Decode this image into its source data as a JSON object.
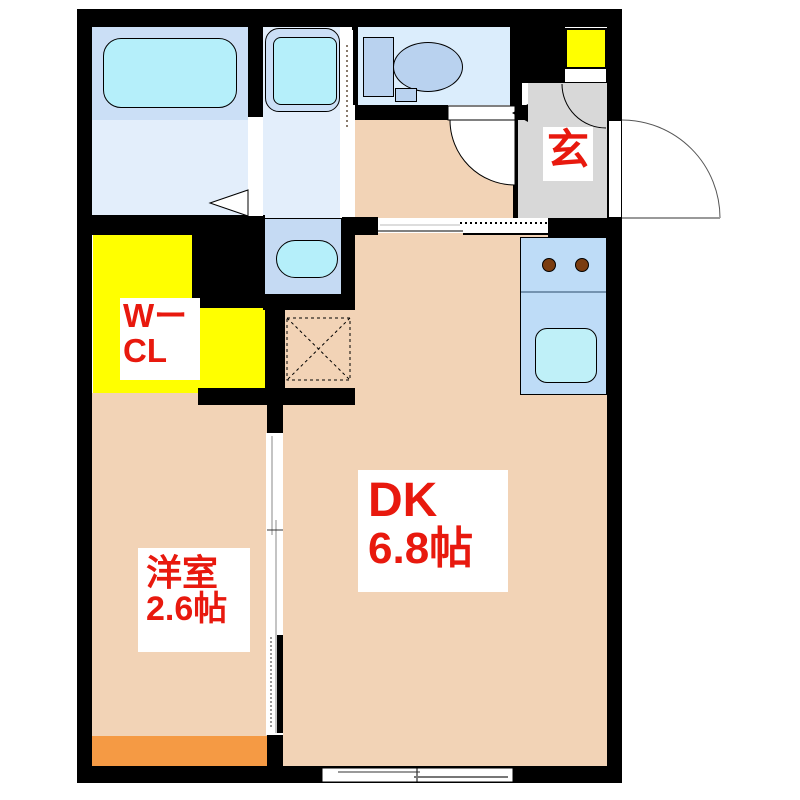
{
  "plan_title": "1DK floor plan",
  "labels": {
    "entrance": "玄",
    "dk": {
      "name": "DK",
      "size": "6.8帖"
    },
    "western_room": {
      "name": "洋室",
      "size": "2.6帖"
    },
    "walkin_closet": {
      "line1": "Wー",
      "line2": "CL"
    }
  },
  "colors": {
    "wall": "#000000",
    "floor_peach": "#f2d3b6",
    "accent_orange": "#f59a44",
    "closet_yellow": "#ffff00",
    "entrance_gray": "#d8d8d8",
    "wet_area_blue": "#cbdff6",
    "wet_floor_blue": "#e3eefb",
    "fixture_cyan": "#b5effa",
    "kitchen_blue": "#bedcf7",
    "toilet_blue": "#b9d2ef",
    "burner_brown": "#7a3c10",
    "label_red": "#e8190e"
  },
  "fixtures": [
    "bathtub",
    "washing-machine-pan",
    "washbasin",
    "toilet",
    "kitchen-sink",
    "stove-burners",
    "refrigerator-space",
    "shoe-cabinet",
    "entrance-door",
    "sliding-doors",
    "window"
  ]
}
